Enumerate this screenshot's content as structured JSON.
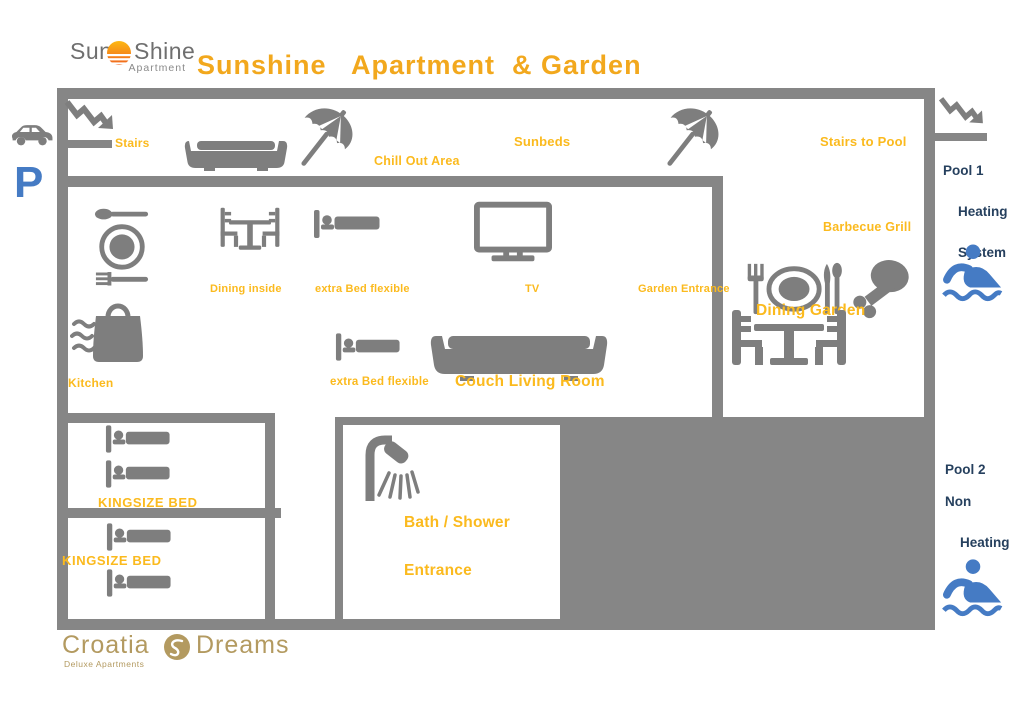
{
  "colors": {
    "wall": "#868686",
    "icon": "#7e7e7e",
    "label": "#fbba1e",
    "title": "#f2a81d",
    "navy": "#26405e",
    "blue": "#457bc4",
    "gold": "#b39a60",
    "logo_gray": "#6f6f6f",
    "sun_orange": "#f6921e"
  },
  "header": {
    "logo_sun": "Sun",
    "logo_shine": "Shine",
    "logo_sub": "Apartment",
    "title": "Sunshine   Apartment  & Garden"
  },
  "exterior": {
    "parking": "P",
    "pool1_line1": "Pool 1",
    "pool1_line2": "Heating",
    "pool1_line3": "System",
    "pool2_line1": "Pool 2",
    "pool2_line2": "Non",
    "pool2_line3": "Heating"
  },
  "terrace": {
    "stairs": "Stairs",
    "chill_out": "Chill Out Area",
    "sunbeds": "Sunbeds",
    "stairs_to_pool": "Stairs to Pool"
  },
  "living": {
    "dining_inside": "Dining inside",
    "extra_bed_top": "extra Bed flexible",
    "tv": "TV",
    "garden_entrance": "Garden Entrance",
    "kitchen": "Kitchen",
    "extra_bed_mid": "extra Bed flexible",
    "couch": "Couch Living Room"
  },
  "garden": {
    "barbecue": "Barbecue Grill",
    "dining_garden": "Dining Garden"
  },
  "rooms": {
    "bedroom1": "KINGSIZE BED",
    "bedroom2": "KINGSIZE BED",
    "bath": "Bath / Shower",
    "entrance": "Entrance"
  },
  "footer": {
    "brand_left": "Croatia",
    "brand_right": "Dreams",
    "brand_sub": "Deluxe Apartments"
  }
}
